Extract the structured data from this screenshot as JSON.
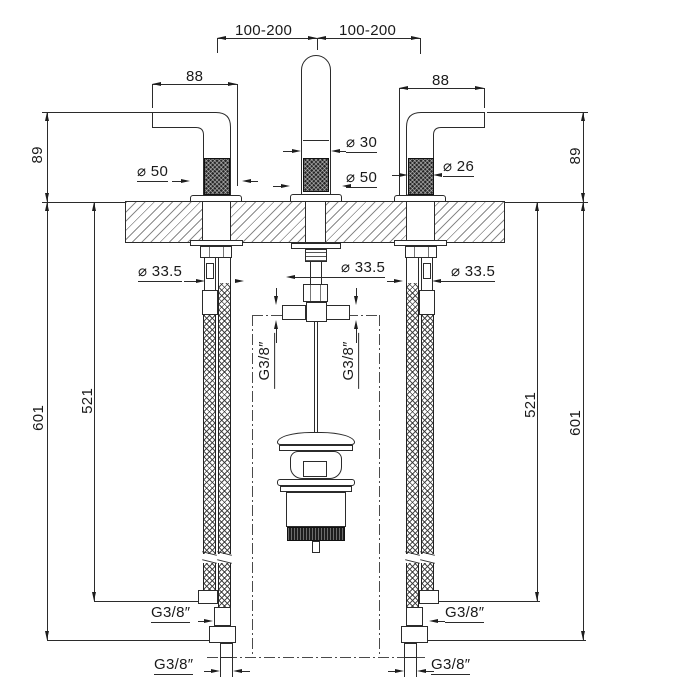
{
  "drawing_labels": {
    "span_left": "100-200",
    "span_right": "100-200",
    "width_left": "88",
    "width_right": "88",
    "height_left": "89",
    "height_right": "89",
    "dia_flange_left": "⌀ 50",
    "dia_spout": "⌀ 30",
    "dia_spout_base": "⌀ 50",
    "dia_grip_right": "⌀ 26",
    "dia_hole_left": "⌀ 33.5",
    "dia_hole_center": "⌀ 33.5",
    "dia_hole_right": "⌀ 33.5",
    "len_outer_left": "601",
    "len_inner_left": "521",
    "len_inner_right": "521",
    "len_outer_right": "601",
    "thread_tee_left": "G3/8″",
    "thread_tee_right": "G3/8″",
    "thread_hose_left": "G3/8″",
    "thread_hose_right": "G3/8″",
    "thread_supply_left": "G3/8″",
    "thread_supply_right": "G3/8″"
  },
  "colors": {
    "background": "#ffffff",
    "line": "#2b2b2b",
    "text": "#1a1a1a",
    "dark_fill": "#1d1d1d"
  }
}
